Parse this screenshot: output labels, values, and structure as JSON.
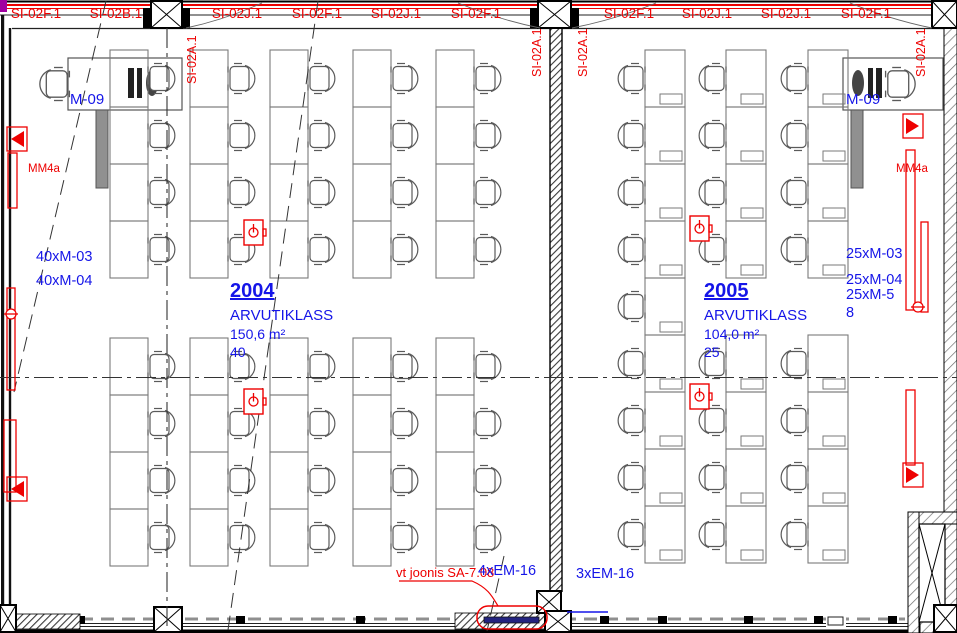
{
  "drawing": {
    "top_labels_h": [
      "SI-02F.1",
      "SI-02B.1",
      "SI-02J.1",
      "SI-02F.1",
      "SI-02J.1",
      "SI-02F.1",
      "SI-02F.1",
      "SI-02J.1",
      "SI-02J.1",
      "SI-02F.1"
    ],
    "top_labels_v": [
      "SI-02A.1",
      "SI-02A.1",
      "SI-02A.1",
      "SI-02A.1"
    ]
  },
  "rooms": [
    {
      "number": "2004",
      "name": "ARVUTIKLASS",
      "area": "150,6 m²",
      "seats": "40",
      "teacher_station": "M-09",
      "equipment": [
        "40xM-03",
        "40xM-04"
      ]
    },
    {
      "number": "2005",
      "name": "ARVUTIKLASS",
      "area": "104,0 m²",
      "seats": "25",
      "teacher_station": "M-09",
      "equipment": [
        "25xM-03",
        "25xM-04",
        "25xM-5",
        "8"
      ]
    }
  ],
  "annotations": {
    "mm4a_left": "MM4a",
    "mm4a_right": "MM4a",
    "ref_note": "vt joonis SA-7.08",
    "em_labels": [
      "4xEM-16",
      "3xEM-16"
    ]
  },
  "colors": {
    "red": "#ee0000",
    "blue": "#1515e8",
    "navy": "#232380",
    "desk": "#7a7a7a",
    "line": "#1a1a1a"
  }
}
